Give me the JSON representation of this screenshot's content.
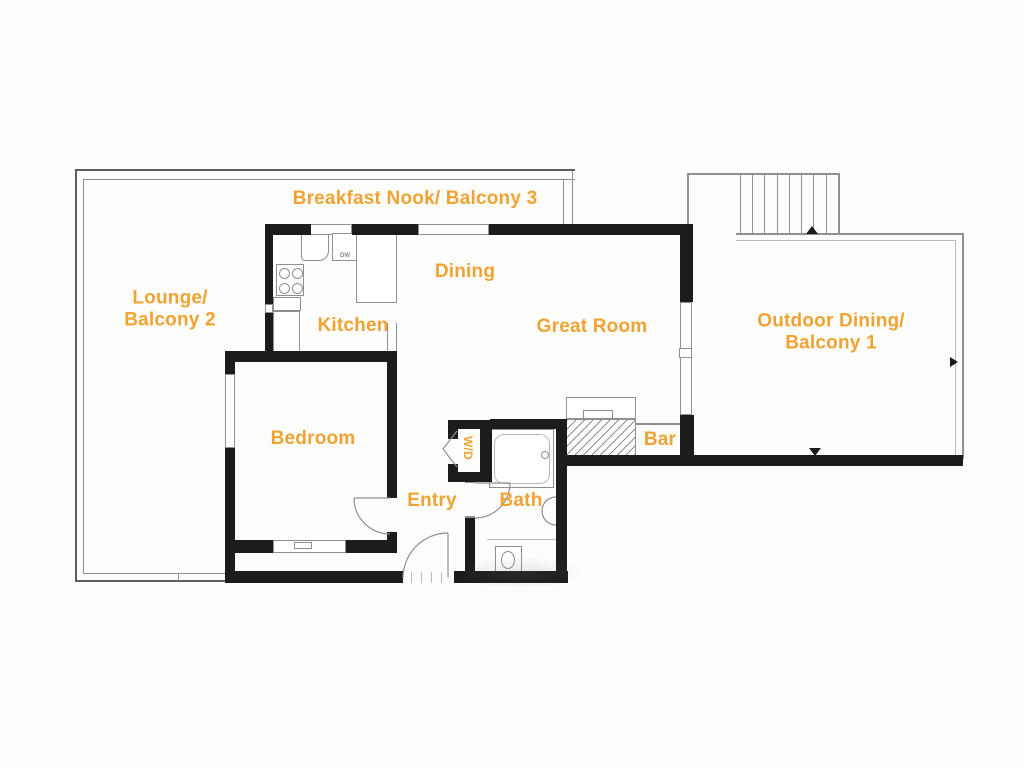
{
  "colors": {
    "wall": "#1c1c1c",
    "line_dark": "#5f5f5f",
    "line_mid": "#8f8f8f",
    "line_light": "#b9b9b9",
    "label": "#f0a232",
    "paper": "#fdfdfb"
  },
  "labels": [
    {
      "name": "room-label-breakfast-nook-balcony-3",
      "lines": [
        "Breakfast Nook/ Balcony 3"
      ],
      "x": 415,
      "y": 199,
      "size": 19
    },
    {
      "name": "room-label-lounge-balcony-2",
      "lines": [
        "Lounge/",
        "Balcony 2"
      ],
      "x": 170,
      "y": 310,
      "size": 19
    },
    {
      "name": "room-label-kitchen",
      "lines": [
        "Kitchen"
      ],
      "x": 353,
      "y": 326,
      "size": 19
    },
    {
      "name": "room-label-dining",
      "lines": [
        "Dining"
      ],
      "x": 465,
      "y": 272,
      "size": 19
    },
    {
      "name": "room-label-great-room",
      "lines": [
        "Great Room"
      ],
      "x": 592,
      "y": 327,
      "size": 19
    },
    {
      "name": "room-label-outdoor-dining-balcony-1",
      "lines": [
        "Outdoor Dining/",
        "Balcony 1"
      ],
      "x": 831,
      "y": 333,
      "size": 19
    },
    {
      "name": "room-label-bedroom",
      "lines": [
        "Bedroom"
      ],
      "x": 313,
      "y": 439,
      "size": 19
    },
    {
      "name": "room-label-wd",
      "lines": [
        "W/D"
      ],
      "x": 468,
      "y": 448,
      "size": 12,
      "rotate": 90
    },
    {
      "name": "room-label-bar",
      "lines": [
        "Bar"
      ],
      "x": 660,
      "y": 440,
      "size": 19
    },
    {
      "name": "room-label-entry",
      "lines": [
        "Entry"
      ],
      "x": 432,
      "y": 501,
      "size": 19
    },
    {
      "name": "room-label-bath",
      "lines": [
        "Bath"
      ],
      "x": 521,
      "y": 501,
      "size": 19
    }
  ],
  "tiny_texts": [
    {
      "name": "appliance-label-dw",
      "text": "DW",
      "x": 345,
      "y": 256,
      "size": 6,
      "color": "#8a8a8a"
    }
  ],
  "geometry": {
    "walls": [
      {
        "name": "top-wall-west",
        "x": 265,
        "y": 224,
        "w": 46,
        "h": 11
      },
      {
        "name": "top-wall-mid",
        "x": 352,
        "y": 224,
        "w": 66,
        "h": 11
      },
      {
        "name": "top-wall-east",
        "x": 489,
        "y": 224,
        "w": 204,
        "h": 11
      },
      {
        "name": "kitchen-west-wall-upper",
        "x": 265,
        "y": 224,
        "w": 8,
        "h": 80
      },
      {
        "name": "kitchen-west-wall-lower",
        "x": 265,
        "y": 313,
        "w": 8,
        "h": 42
      },
      {
        "name": "bedroom-north-wall",
        "x": 225,
        "y": 351,
        "w": 172,
        "h": 11
      },
      {
        "name": "bedroom-west-wall-upper",
        "x": 225,
        "y": 351,
        "w": 10,
        "h": 23
      },
      {
        "name": "bedroom-west-wall-lower",
        "x": 225,
        "y": 448,
        "w": 10,
        "h": 135
      },
      {
        "name": "bedroom-east-wall-upper",
        "x": 387,
        "y": 351,
        "w": 10,
        "h": 147
      },
      {
        "name": "bedroom-east-wall-lower",
        "x": 387,
        "y": 532,
        "w": 10,
        "h": 21
      },
      {
        "name": "bedroom-south-wall-west",
        "x": 225,
        "y": 540,
        "w": 48,
        "h": 13
      },
      {
        "name": "bedroom-south-wall-east",
        "x": 346,
        "y": 540,
        "w": 51,
        "h": 13
      },
      {
        "name": "south-exterior-wall-west",
        "x": 225,
        "y": 571,
        "w": 178,
        "h": 12
      },
      {
        "name": "south-exterior-wall-east",
        "x": 454,
        "y": 571,
        "w": 114,
        "h": 12
      },
      {
        "name": "wd-north-wall",
        "x": 448,
        "y": 420,
        "w": 44,
        "h": 9
      },
      {
        "name": "wd-west-stub-upper",
        "x": 448,
        "y": 420,
        "w": 10,
        "h": 19
      },
      {
        "name": "wd-west-stub-lower",
        "x": 448,
        "y": 464,
        "w": 10,
        "h": 18
      },
      {
        "name": "wd-south-wall",
        "x": 448,
        "y": 472,
        "w": 44,
        "h": 10
      },
      {
        "name": "wd-east-wall",
        "x": 480,
        "y": 420,
        "w": 12,
        "h": 62
      },
      {
        "name": "bath-north-wall",
        "x": 490,
        "y": 419,
        "w": 77,
        "h": 10
      },
      {
        "name": "bath-west-wall",
        "x": 465,
        "y": 518,
        "w": 10,
        "h": 60
      },
      {
        "name": "bath-east-wall",
        "x": 556,
        "y": 419,
        "w": 11,
        "h": 164
      },
      {
        "name": "south-wall-great-room-and-balcony",
        "x": 556,
        "y": 455,
        "w": 407,
        "h": 11
      },
      {
        "name": "great-room-east-wall-upper",
        "x": 680,
        "y": 224,
        "w": 13,
        "h": 78
      },
      {
        "name": "great-room-east-wall-lower",
        "x": 680,
        "y": 415,
        "w": 14,
        "h": 43
      }
    ],
    "lines": [
      {
        "name": "balcony2-north-outer",
        "x": 75,
        "y": 169,
        "w": 500,
        "h": 2,
        "c": "d"
      },
      {
        "name": "balcony2-north-inner",
        "x": 83,
        "y": 179,
        "w": 492,
        "h": 1,
        "c": "m"
      },
      {
        "name": "balcony2-west-outer",
        "x": 75,
        "y": 169,
        "w": 2,
        "h": 413,
        "c": "d"
      },
      {
        "name": "balcony2-west-inner",
        "x": 83,
        "y": 179,
        "w": 1,
        "h": 395,
        "c": "m"
      },
      {
        "name": "balcony2-south-outer",
        "x": 75,
        "y": 580,
        "w": 151,
        "h": 2,
        "c": "d"
      },
      {
        "name": "balcony2-south-inner",
        "x": 83,
        "y": 573,
        "w": 143,
        "h": 1,
        "c": "m"
      },
      {
        "name": "balcony2-south-tick",
        "x": 178,
        "y": 573,
        "w": 1,
        "h": 8,
        "c": "m"
      },
      {
        "name": "nook-east-connector-inner",
        "x": 563,
        "y": 180,
        "w": 1,
        "h": 44,
        "c": "m"
      },
      {
        "name": "nook-east-connector-outer",
        "x": 572,
        "y": 171,
        "w": 1,
        "h": 53,
        "c": "m"
      },
      {
        "name": "stairs-north-line",
        "x": 687,
        "y": 173,
        "w": 153,
        "h": 2,
        "c": "m"
      },
      {
        "name": "stairs-west-line",
        "x": 687,
        "y": 173,
        "w": 2,
        "h": 62,
        "c": "m"
      },
      {
        "name": "stairs-east-line",
        "x": 838,
        "y": 173,
        "w": 2,
        "h": 62,
        "c": "m"
      },
      {
        "name": "stair-tread-1",
        "x": 740,
        "y": 175,
        "w": 1,
        "h": 60,
        "c": "m"
      },
      {
        "name": "stair-tread-2",
        "x": 752,
        "y": 175,
        "w": 1,
        "h": 60,
        "c": "m"
      },
      {
        "name": "stair-tread-3",
        "x": 764,
        "y": 175,
        "w": 1,
        "h": 60,
        "c": "m"
      },
      {
        "name": "stair-tread-4",
        "x": 777,
        "y": 175,
        "w": 1,
        "h": 60,
        "c": "m"
      },
      {
        "name": "stair-tread-5",
        "x": 789,
        "y": 175,
        "w": 1,
        "h": 60,
        "c": "m"
      },
      {
        "name": "stair-tread-6",
        "x": 801,
        "y": 175,
        "w": 1,
        "h": 60,
        "c": "m"
      },
      {
        "name": "stair-tread-7",
        "x": 813,
        "y": 175,
        "w": 1,
        "h": 60,
        "c": "m"
      },
      {
        "name": "stair-tread-8",
        "x": 826,
        "y": 175,
        "w": 1,
        "h": 60,
        "c": "m"
      },
      {
        "name": "balcony1-west-line",
        "x": 689,
        "y": 235,
        "w": 2,
        "h": 221,
        "c": "m"
      },
      {
        "name": "balcony1-north-outer",
        "x": 736,
        "y": 233,
        "w": 228,
        "h": 2,
        "c": "m"
      },
      {
        "name": "balcony1-north-inner",
        "x": 736,
        "y": 240,
        "w": 219,
        "h": 1,
        "c": "l"
      },
      {
        "name": "balcony1-east-outer",
        "x": 962,
        "y": 233,
        "w": 2,
        "h": 226,
        "c": "m"
      },
      {
        "name": "balcony1-east-inner",
        "x": 955,
        "y": 240,
        "w": 1,
        "h": 217,
        "c": "l"
      },
      {
        "name": "bar-counter-line",
        "x": 636,
        "y": 423,
        "w": 44,
        "h": 2,
        "c": "m"
      },
      {
        "name": "kitchen-opening-jamb-west",
        "x": 387,
        "y": 323,
        "w": 1,
        "h": 28,
        "c": "m"
      },
      {
        "name": "kitchen-opening-jamb-east",
        "x": 396,
        "y": 323,
        "w": 1,
        "h": 28,
        "c": "m"
      },
      {
        "name": "bath-mid-line",
        "x": 487,
        "y": 539,
        "w": 69,
        "h": 1,
        "c": "l"
      },
      {
        "name": "top-window2-mid-line",
        "x": 418,
        "y": 229,
        "w": 71,
        "h": 1,
        "c": "m"
      },
      {
        "name": "slider-tick",
        "x": 683,
        "y": 381,
        "w": 6,
        "h": 2,
        "c": "m"
      },
      {
        "name": "bedroom-west-window-tick-1",
        "x": 225,
        "y": 406,
        "w": 10,
        "h": 2,
        "c": "m"
      },
      {
        "name": "bedroom-west-window-tick-2",
        "x": 225,
        "y": 413,
        "w": 10,
        "h": 2,
        "c": "m"
      },
      {
        "name": "bath-door-jamb-top",
        "x": 465,
        "y": 481,
        "w": 10,
        "h": 2,
        "c": "m"
      },
      {
        "name": "bath-door-jamb-bottom",
        "x": 465,
        "y": 516,
        "w": 10,
        "h": 2,
        "c": "m"
      },
      {
        "name": "entry-threshold-tick-1",
        "x": 411,
        "y": 572,
        "w": 1,
        "h": 11,
        "c": "l"
      },
      {
        "name": "entry-threshold-tick-2",
        "x": 421,
        "y": 572,
        "w": 1,
        "h": 11,
        "c": "l"
      },
      {
        "name": "entry-threshold-tick-3",
        "x": 431,
        "y": 572,
        "w": 1,
        "h": 11,
        "c": "l"
      },
      {
        "name": "entry-threshold-tick-4",
        "x": 441,
        "y": 572,
        "w": 1,
        "h": 11,
        "c": "l"
      }
    ],
    "boxes": [
      {
        "name": "window-breakfast-nook-west",
        "x": 310,
        "y": 224,
        "w": 42,
        "h": 11
      },
      {
        "name": "window-breakfast-nook-east",
        "x": 418,
        "y": 224,
        "w": 71,
        "h": 11
      },
      {
        "name": "window-kitchen-west-small",
        "x": 265,
        "y": 304,
        "w": 8,
        "h": 9
      },
      {
        "name": "window-bedroom-west",
        "x": 225,
        "y": 374,
        "w": 10,
        "h": 74
      },
      {
        "name": "window-bedroom-south",
        "x": 273,
        "y": 540,
        "w": 73,
        "h": 13
      },
      {
        "name": "window-bedroom-south-sill",
        "x": 294,
        "y": 542,
        "w": 18,
        "h": 7
      },
      {
        "name": "sliding-door-great-room-east",
        "x": 680,
        "y": 302,
        "w": 12,
        "h": 113
      },
      {
        "name": "sliding-door-handle",
        "x": 679,
        "y": 348,
        "w": 13,
        "h": 10
      },
      {
        "name": "kitchen-sink",
        "x": 301,
        "y": 234,
        "w": 28,
        "h": 27,
        "br": "0 0 10px 4px"
      },
      {
        "name": "kitchen-sink-faucet",
        "x": 303,
        "y": 229,
        "w": 8,
        "h": 5
      },
      {
        "name": "kitchen-dishwasher",
        "x": 332,
        "y": 233,
        "w": 26,
        "h": 28
      },
      {
        "name": "kitchen-fridge-pantry",
        "x": 356,
        "y": 233,
        "w": 41,
        "h": 70
      },
      {
        "name": "kitchen-stove",
        "x": 276,
        "y": 264,
        "w": 28,
        "h": 32
      },
      {
        "name": "kitchen-counter-upper",
        "x": 273,
        "y": 297,
        "w": 28,
        "h": 14
      },
      {
        "name": "kitchen-counter-lower",
        "x": 273,
        "y": 311,
        "w": 27,
        "h": 41
      },
      {
        "name": "fireplace-hearth",
        "x": 566,
        "y": 397,
        "w": 70,
        "h": 22
      },
      {
        "name": "fireplace-notch",
        "x": 583,
        "y": 410,
        "w": 30,
        "h": 9
      },
      {
        "name": "bathtub",
        "x": 489,
        "y": 429,
        "w": 65,
        "h": 59
      },
      {
        "name": "bathtub-inner",
        "x": 494,
        "y": 434,
        "w": 56,
        "h": 50,
        "br": "10px",
        "bc": "l"
      },
      {
        "name": "toilet-tank",
        "x": 495,
        "y": 546,
        "w": 27,
        "h": 26
      }
    ],
    "circles": [
      {
        "name": "stove-burner-1",
        "cx": 284,
        "cy": 273,
        "rx": 5.5,
        "ry": 5.5
      },
      {
        "name": "stove-burner-2",
        "cx": 297,
        "cy": 273,
        "rx": 5.5,
        "ry": 5.5
      },
      {
        "name": "stove-burner-3",
        "cx": 284,
        "cy": 288,
        "rx": 5.5,
        "ry": 5.5
      },
      {
        "name": "stove-burner-4",
        "cx": 297,
        "cy": 288,
        "rx": 5.5,
        "ry": 5.5
      },
      {
        "name": "tub-faucet",
        "cx": 545,
        "cy": 455,
        "rx": 4,
        "ry": 4
      },
      {
        "name": "toilet-bowl",
        "cx": 508,
        "cy": 560,
        "rx": 7,
        "ry": 9
      }
    ],
    "hatches": [
      {
        "name": "fireplace-hatched-box",
        "x": 566,
        "y": 419,
        "w": 70,
        "h": 37
      }
    ],
    "triangles": [
      {
        "name": "stairs-up-arrow",
        "x": 806,
        "y": 226,
        "dir": "up",
        "s": 8
      },
      {
        "name": "balcony1-door-arrow",
        "x": 809,
        "y": 448,
        "dir": "down",
        "s": 8
      },
      {
        "name": "balcony1-side-arrow",
        "x": 950,
        "y": 357,
        "dir": "right",
        "s": 8
      }
    ],
    "arcs": [
      {
        "name": "bedroom-door-leaf",
        "d": "M390 498 L354 498"
      },
      {
        "name": "bedroom-door-swing",
        "d": "M354 498 A36 36 0 0 0 390 534"
      },
      {
        "name": "entry-door-leaf",
        "d": "M448 533 L448 577"
      },
      {
        "name": "entry-door-swing",
        "d": "M448 533 A45 45 0 0 0 403 578"
      },
      {
        "name": "bath-door-leaf",
        "d": "M475 483 L510 483"
      },
      {
        "name": "bath-door-swing",
        "d": "M510 483 A35 35 0 0 1 475 518"
      },
      {
        "name": "wd-bifold-door",
        "d": "M457 431 L443 449 L457 467"
      },
      {
        "name": "bath-sink-bowl",
        "d": "M556 497 A14 14 0 0 0 556 525"
      }
    ],
    "smudges": [
      {
        "name": "scan-smudge",
        "x": 455,
        "y": 556,
        "w": 130,
        "h": 34
      }
    ]
  }
}
